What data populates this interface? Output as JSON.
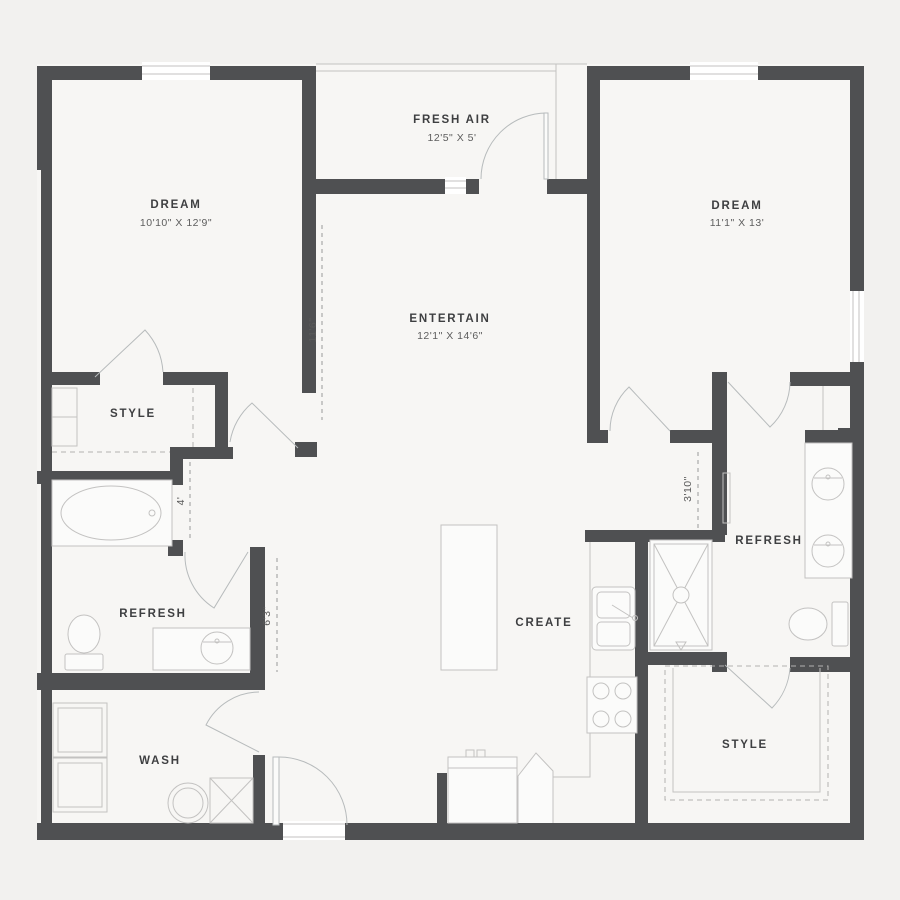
{
  "plan": {
    "type": "apartment-floor-plan",
    "colors": {
      "background": "#f2f1ef",
      "floor": "#f7f6f4",
      "wall": "#4f5052",
      "fixture_line": "#c3c2c1",
      "door_line": "#b7bbbc",
      "dash_line": "#9a9a9a",
      "label_text": "#3e3f41",
      "dim_text": "#5a5a5d"
    },
    "rooms": {
      "dream_left": {
        "name": "DREAM",
        "dims": "10'10\" X 12'9\""
      },
      "fresh_air": {
        "name": "FRESH AIR",
        "dims": "12'5\" X 5'"
      },
      "dream_right": {
        "name": "DREAM",
        "dims": "11'1\" X 13'"
      },
      "entertain": {
        "name": "ENTERTAIN",
        "dims": "12'1\" X 14'6\""
      },
      "style_left": {
        "name": "STYLE"
      },
      "refresh_left": {
        "name": "REFRESH"
      },
      "wash": {
        "name": "WASH"
      },
      "create": {
        "name": "CREATE"
      },
      "refresh_right": {
        "name": "REFRESH"
      },
      "style_right": {
        "name": "STYLE"
      }
    },
    "dimensions": {
      "entertain_hall": "11'6\"",
      "left_hall": "4'",
      "bath_hall": "6'3\"",
      "right_hall": "3'10\""
    }
  }
}
